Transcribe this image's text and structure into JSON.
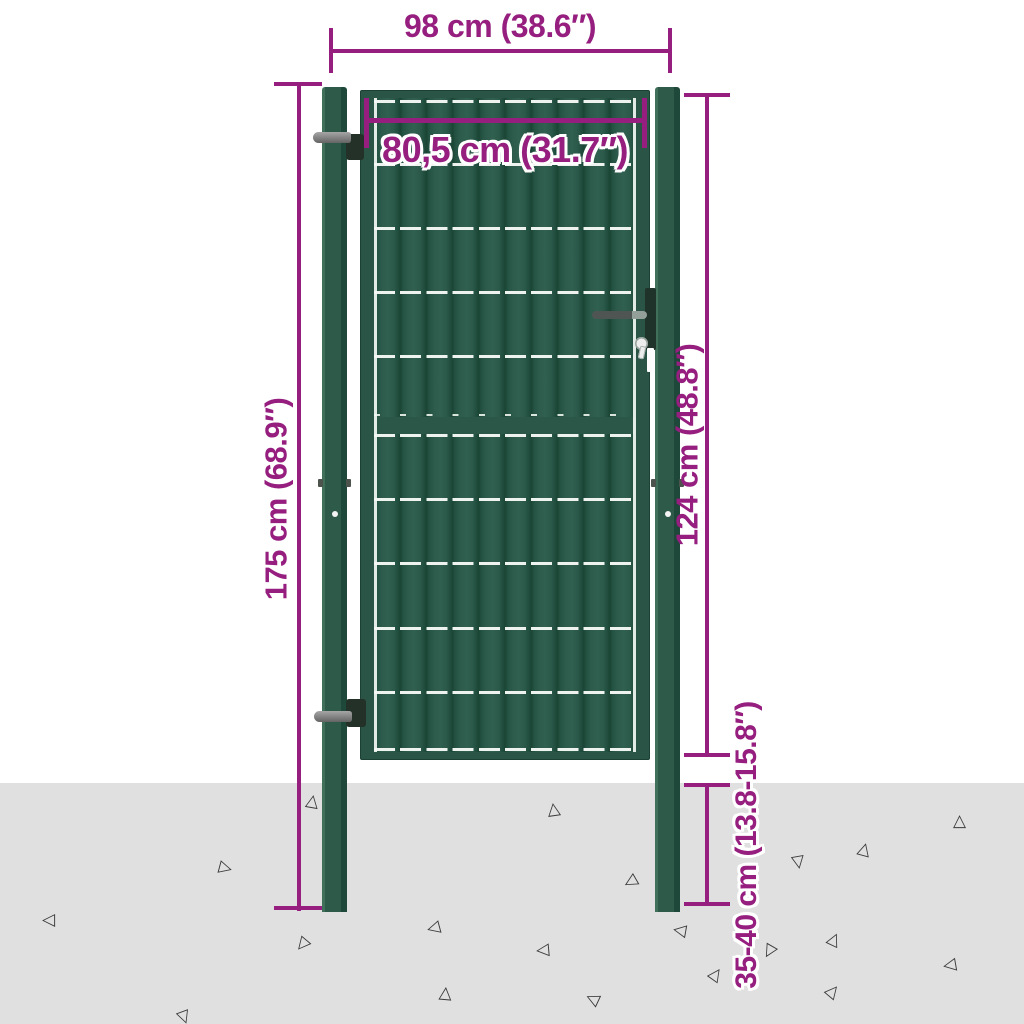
{
  "diagram": {
    "type": "product-dimension-diagram",
    "subject": "steel garden fence gate with two posts set into the ground",
    "dimensions": {
      "opening_width": "98 cm (38.6″)",
      "gate_width": "80,5 cm (31.7″)",
      "post_height": "175 cm (68.9″)",
      "gate_height": "124 cm (48.8″)",
      "underground_depth": "35-40 cm (13.8-15.8″)"
    },
    "colors": {
      "dimension_magenta": "#951e7f",
      "post_green": "#2d5a49",
      "panel_green": "#2b594a",
      "ground_gray": "#e0e0e0",
      "background": "#ffffff"
    }
  }
}
